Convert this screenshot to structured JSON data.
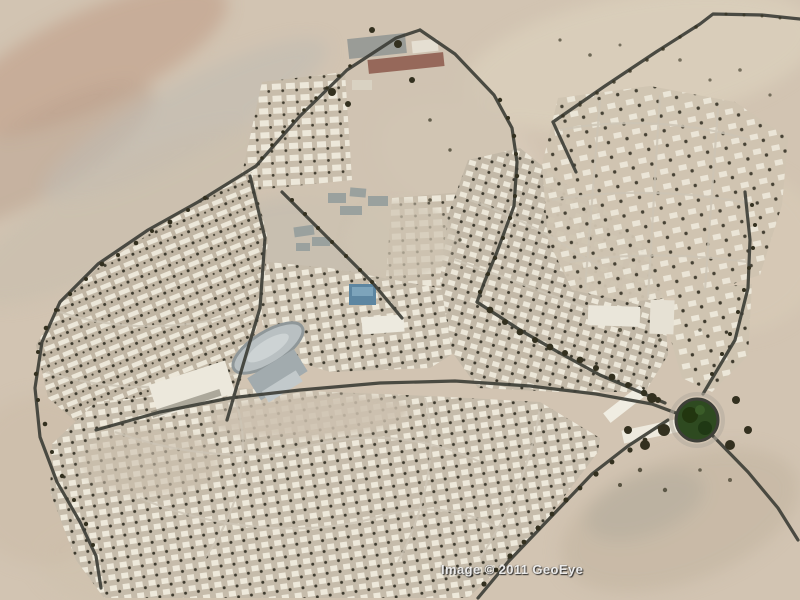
{
  "meta": {
    "type": "satellite-aerial-imagery",
    "description": "Aerial satellite view of a desert town with curving residential streets of small white houses, a walled northern compound, a central school and stadium complex, a tree-filled green roundabout on the east side, dark perimeter roads lined with trees, and open tan desert terrain surrounding the town"
  },
  "watermark": {
    "text": "Image © 2011 GeoEye"
  },
  "palette": {
    "desert_base": "#d2c4b2",
    "desert_light": "#dbcfbc",
    "desert_pink": "#c2a18c",
    "desert_gray": "#bcb8ae",
    "town_ground": "#c9bead",
    "house_white": "#ece7d9",
    "road_dark": "#3e3f38",
    "street_light": "#cdc5b5",
    "tree_dark": "#33301f",
    "roundabout_green": "#2e4a20",
    "roundabout_green_dark": "#22360f",
    "pool_blue": "#5d86a1",
    "red_roof": "#96685a",
    "gray_roof": "#9aa19e",
    "track_gray": "#b9c0c2",
    "white_building": "#ece8dc"
  },
  "features": {
    "roundabout": "tree-filled-roundabout",
    "stadium": "oval-running-track",
    "pool": "blue-pool-or-blue-roof",
    "compound": "north-walled-compound",
    "highway": "northeast-perimeter-highway"
  }
}
